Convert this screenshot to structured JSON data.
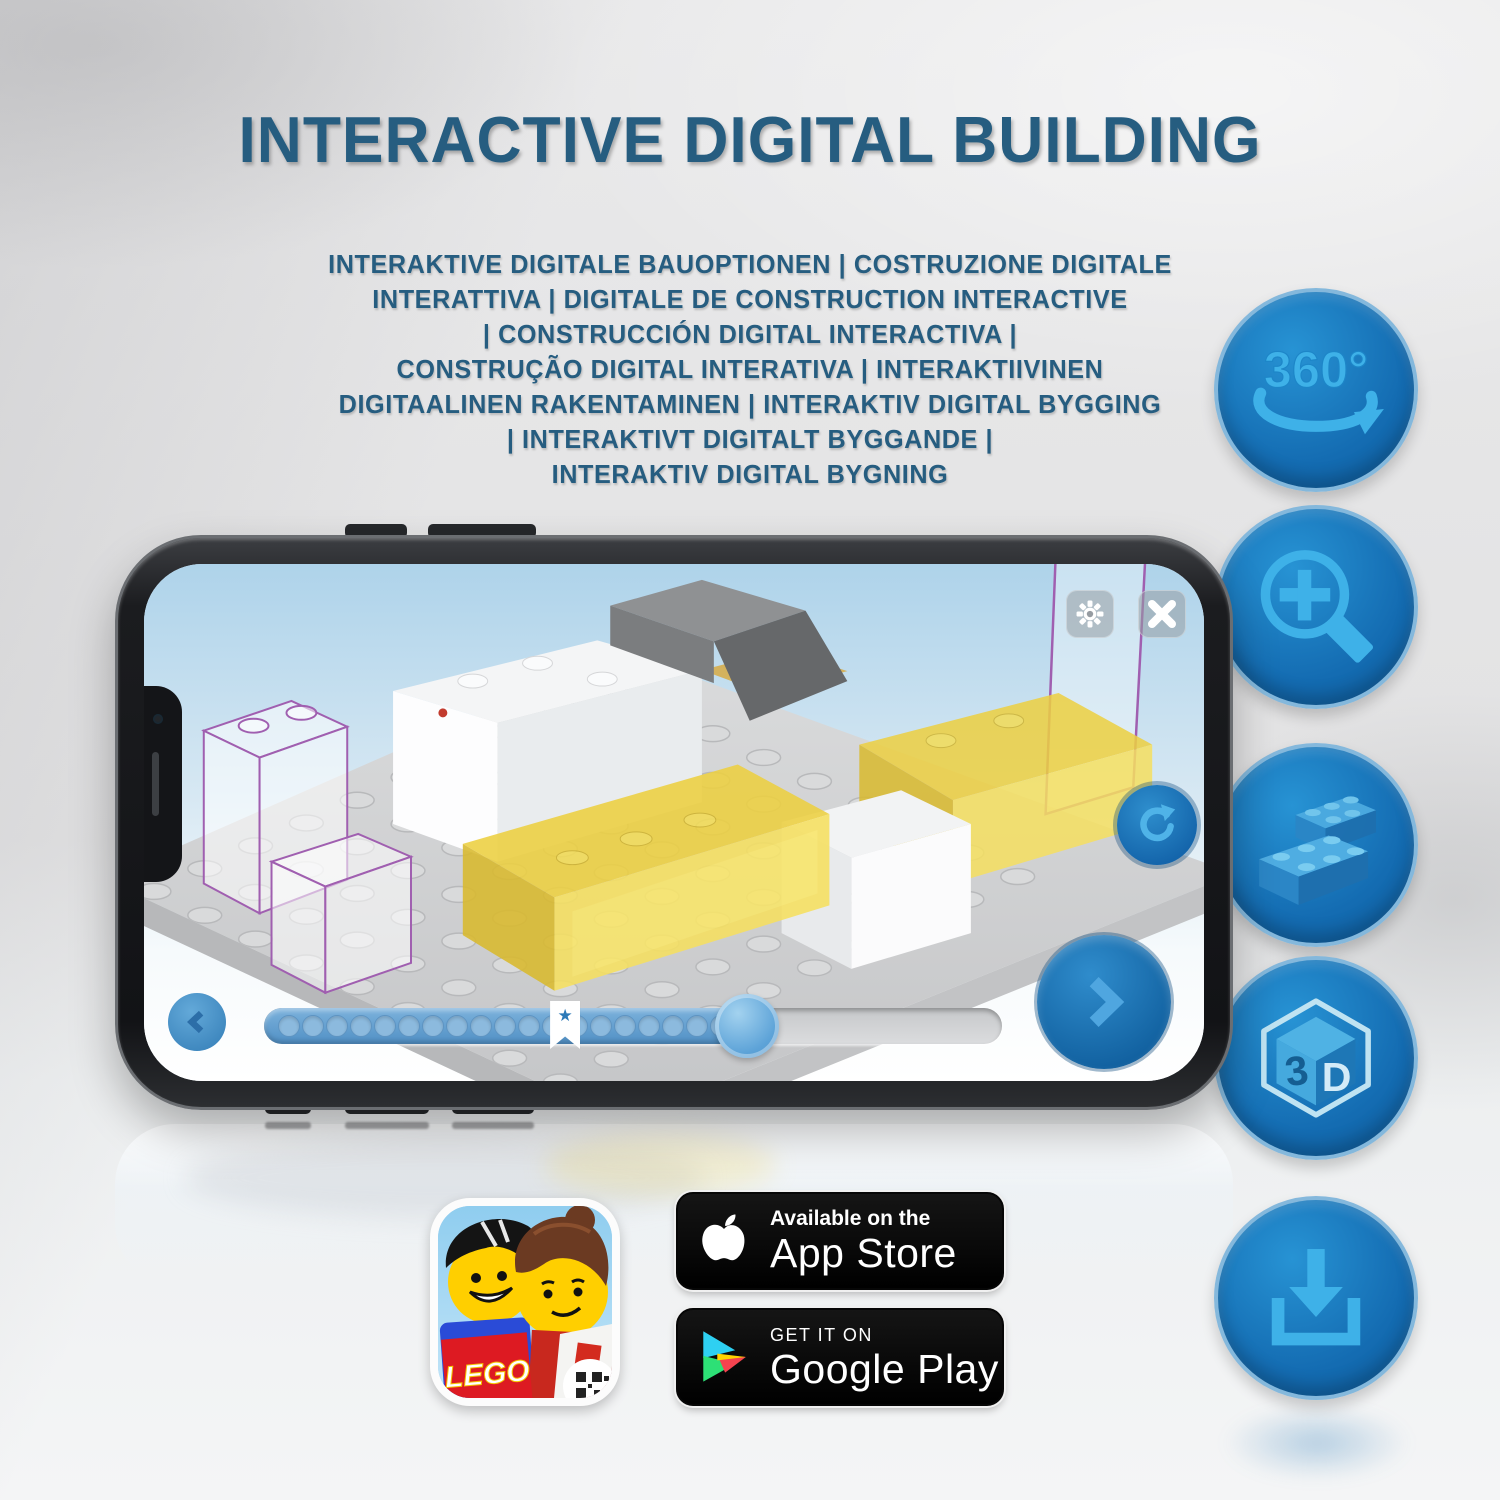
{
  "header": {
    "title": "INTERACTIVE DIGITAL BUILDING",
    "color": "#265d80"
  },
  "subtitle": {
    "lines": [
      "INTERAKTIVE DIGITALE BAUOPTIONEN | COSTRUZIONE DIGITALE",
      "INTERATTIVA | DIGITALE DE CONSTRUCTION INTERACTIVE",
      "| CONSTRUCCIÓN DIGITAL INTERACTIVA |",
      "CONSTRUÇÃO DIGITAL INTERATIVA | INTERAKTIIVINEN",
      "DIGITAALINEN RAKENTAMINEN | INTERAKTIV DIGITAL BYGGING",
      "| INTERAKTIVT DIGITALT BYGGANDE |",
      "INTERAKTIV DIGITAL BYGNING"
    ]
  },
  "features": {
    "circle_color": "#146cb2",
    "rim_color": "#84b8dc",
    "glyph_color": "#3eb1e8",
    "items": [
      {
        "name": "rotate-360-icon",
        "label": "360°"
      },
      {
        "name": "zoom-in-icon",
        "label": ""
      },
      {
        "name": "brick-building-icon",
        "label": ""
      },
      {
        "name": "view-3d-icon",
        "char_left": "3",
        "char_right": "D"
      },
      {
        "name": "download-icon",
        "label": ""
      }
    ]
  },
  "phone": {
    "app": "LEGO digital building instructions 3D viewer",
    "controls": {
      "settings": "gear",
      "close": "x",
      "reset_view": "rotate-clockwise",
      "previous_step": "chevron-left",
      "next_step": "chevron-right"
    },
    "progress": {
      "dot_count": 19,
      "filled_percent": 65.4,
      "bookmark_percent": 40.8
    }
  },
  "store": {
    "app_icon": {
      "logo_text": "LEGO"
    },
    "app_store": {
      "line1": "Available on the",
      "line2": "App Store"
    },
    "google_play": {
      "line1": "GET IT ON",
      "line2": "Google Play"
    }
  },
  "colors": {
    "title_blue": "#265d80",
    "feature_glyph_blue": "#3eb1e8",
    "app_accent_blue": "#1e78bc",
    "brick_yellow": "#edd041",
    "badge_black": "#000000"
  }
}
